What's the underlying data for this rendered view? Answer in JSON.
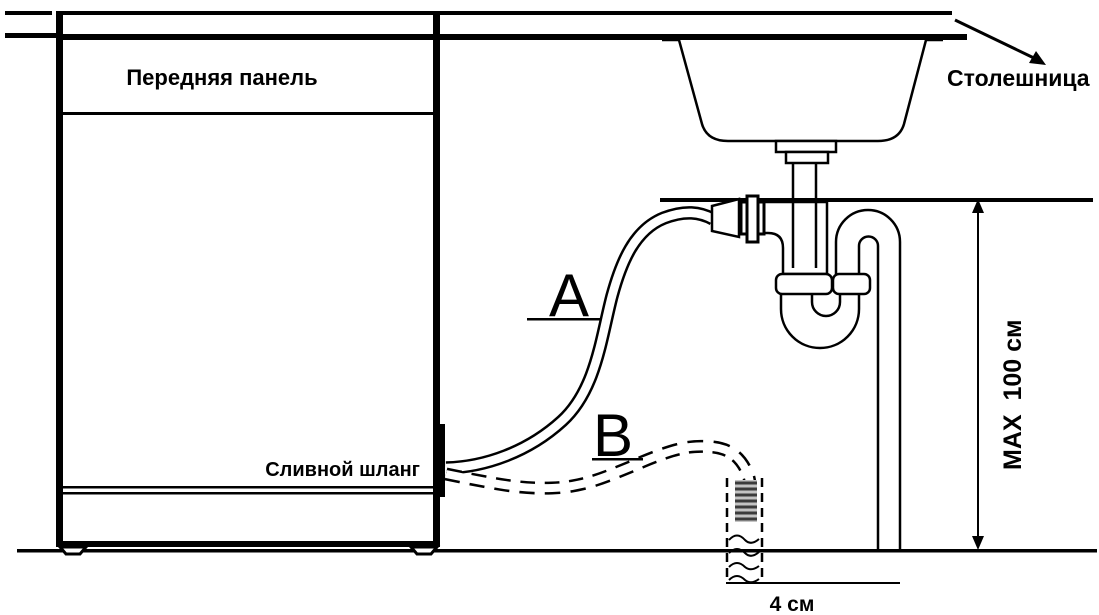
{
  "diagram": {
    "title_hint": "dishwasher drain hose installation scheme",
    "labels": {
      "front_panel": "Передняя панель",
      "countertop": "Столешница",
      "drain_hose": "Сливной шланг",
      "option_a": "A",
      "option_b": "B",
      "max_height": "MAX  100 см",
      "standpipe_width": "4 см"
    },
    "colors": {
      "line": "#000000",
      "background": "#ffffff",
      "hose_end_hatch_bg": "#c4c4c4",
      "hose_end_hatch_stripe": "#3c3c3c"
    }
  }
}
